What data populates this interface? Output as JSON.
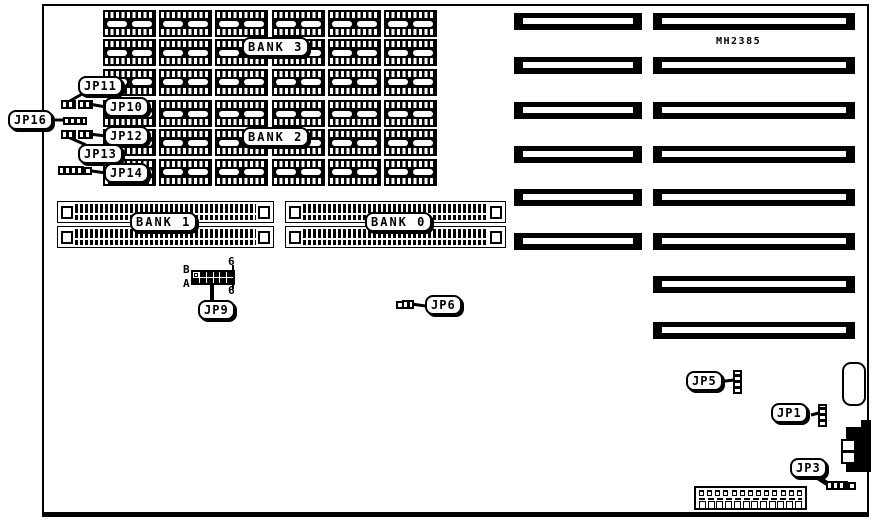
{
  "diagram": {
    "chip_label": "MH2385",
    "dram": {
      "rows_per_group": 3,
      "cols_per_group": 6,
      "groups": [
        {
          "label": "BANK 3"
        },
        {
          "label": "BANK 2"
        }
      ]
    },
    "simm": {
      "sockets_per_bank": 2,
      "banks": [
        {
          "label": "BANK 1"
        },
        {
          "label": "BANK 0"
        }
      ]
    },
    "expansion_slots": {
      "left_column_count": 6,
      "right_column_count": 8
    },
    "jumpers": {
      "jp16": "JP16",
      "jp11": "JP11",
      "jp10": "JP10",
      "jp12": "JP12",
      "jp13": "JP13",
      "jp14": "JP14",
      "jp9": "JP9",
      "jp6": "JP6",
      "jp5": "JP5",
      "jp1": "JP1",
      "jp3": "JP3"
    },
    "jp9_header": {
      "row_top": "B",
      "row_bottom": "A",
      "count_top": "6",
      "count_bottom": "6",
      "rows": 2,
      "cols": 6
    },
    "bottom_connector": {
      "top_pins": 13,
      "bottom_pins": 12
    },
    "colors": {
      "ink": "#000000",
      "paper": "#ffffff"
    }
  }
}
